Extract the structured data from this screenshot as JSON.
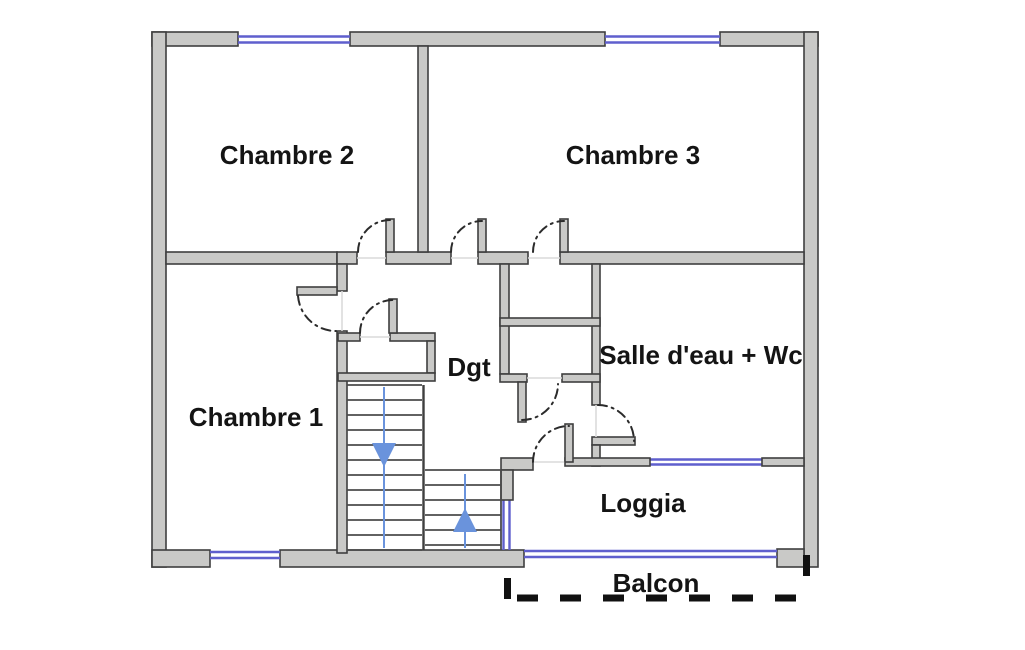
{
  "diagram": {
    "type": "floor-plan",
    "description": "Apartment upper-floor plan with bedrooms, hallway, shower room, stairs, loggia and balcony"
  },
  "rooms": {
    "chambre2": {
      "label": "Chambre 2"
    },
    "chambre3": {
      "label": "Chambre 3"
    },
    "chambre1": {
      "label": "Chambre 1"
    },
    "dgt": {
      "label": "Dgt"
    },
    "salle_eau_wc": {
      "label": "Salle d'eau + Wc"
    },
    "loggia": {
      "label": "Loggia"
    },
    "balcon": {
      "label": "Balcon"
    }
  },
  "stairs": {
    "left_flight_arrow": "down",
    "right_flight_arrow": "up"
  },
  "colors": {
    "background": "#ffffff",
    "wall_fill": "#c9c9c7",
    "wall_outline": "#3f3f3f",
    "window_blue": "#5f5fcd",
    "door_arc": "#2b2b2b",
    "stair_arrow_blue": "#6a93dc",
    "balcony_dash": "#111111",
    "label_text": "#141414"
  }
}
